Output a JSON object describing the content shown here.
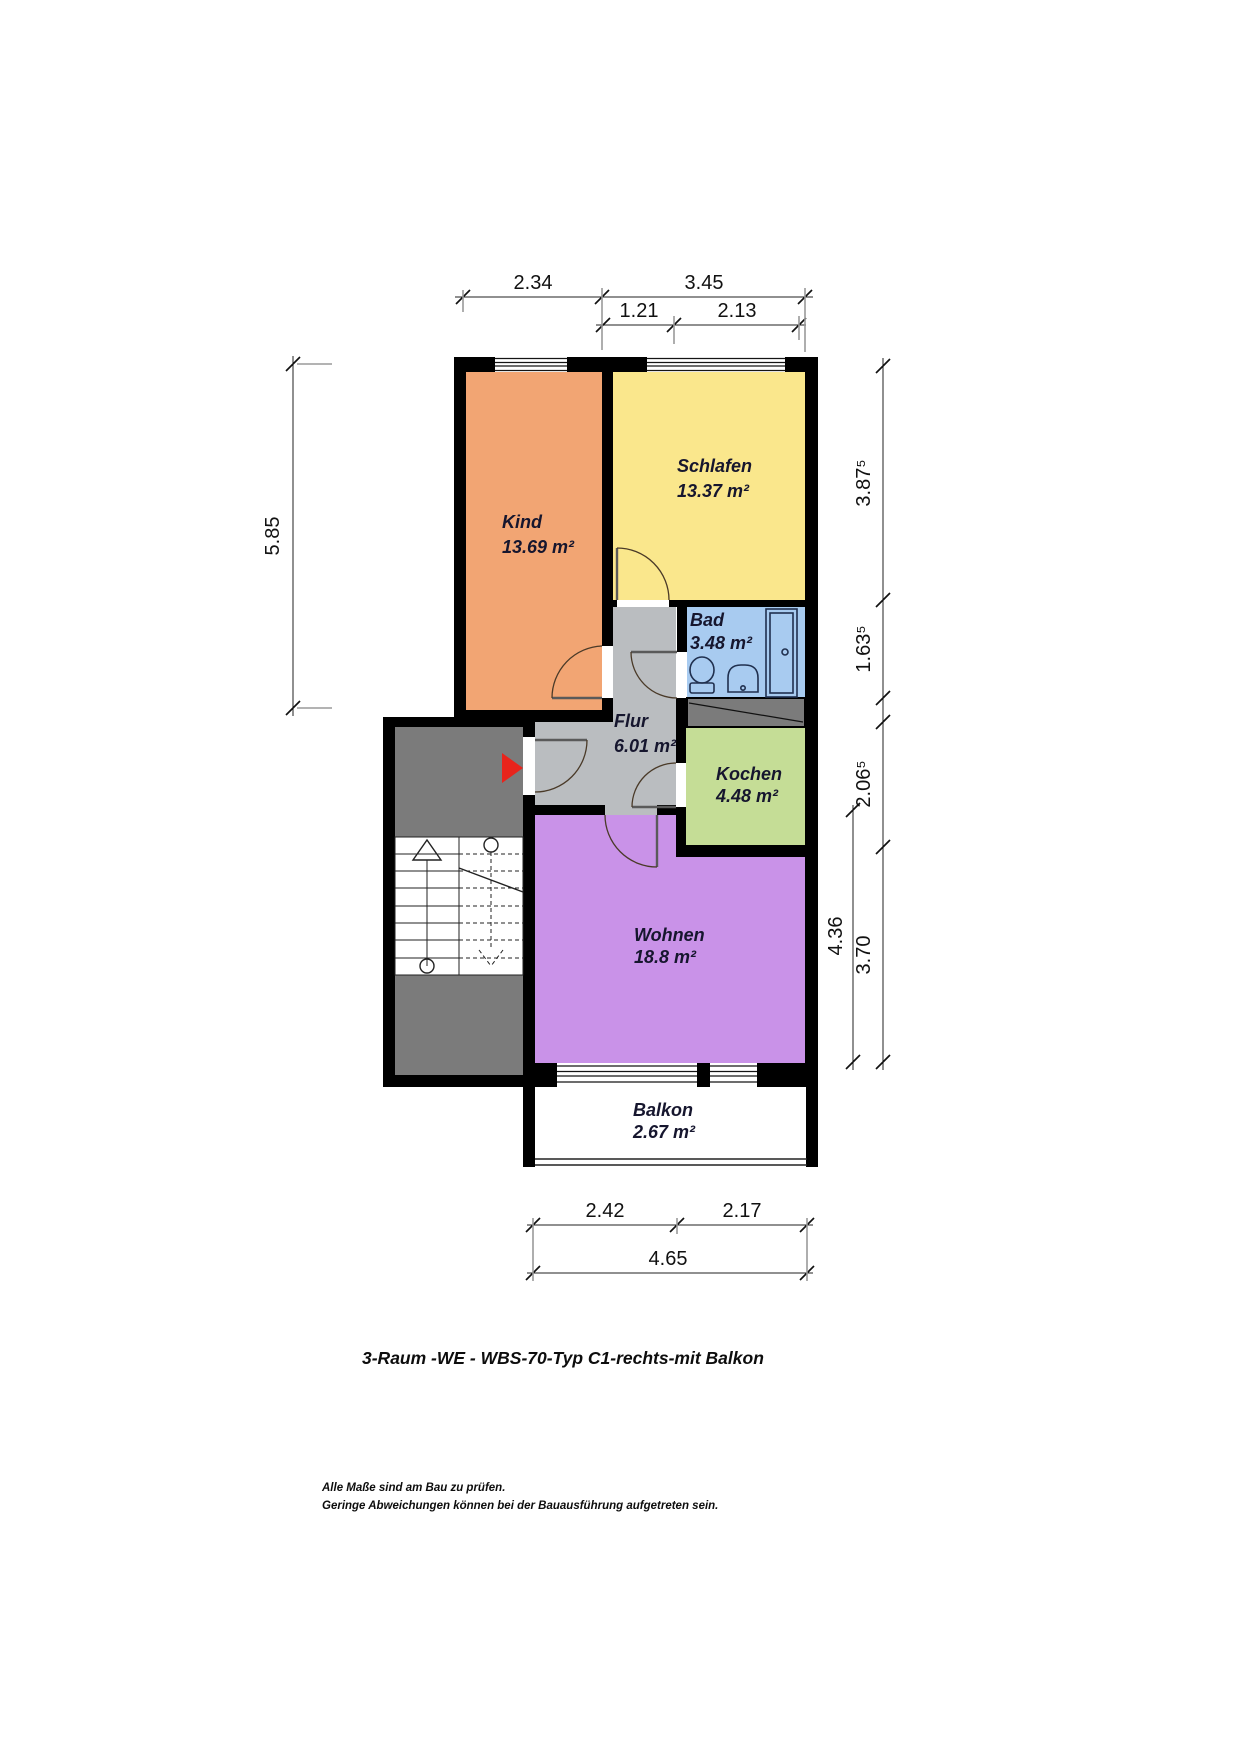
{
  "title": "3-Raum -WE - WBS-70-Typ C1-rechts-mit Balkon",
  "footer": {
    "line1": "Alle Maße sind am Bau zu prüfen.",
    "line2": "Geringe Abweichungen können bei der Bauausführung aufgetreten sein."
  },
  "rooms": [
    {
      "name": "Kind",
      "area": "13.69 m²",
      "color": "#f2a573"
    },
    {
      "name": "Schlafen",
      "area": "13.37 m²",
      "color": "#fae78c"
    },
    {
      "name": "Bad",
      "area": "3.48 m²",
      "color": "#a8cbf0"
    },
    {
      "name": "Flur",
      "area": "6.01 m²",
      "color": "#babdc0"
    },
    {
      "name": "Kochen",
      "area": "4.48 m²",
      "color": "#c5dd96"
    },
    {
      "name": "Wohnen",
      "area": "18.8 m²",
      "color": "#c992e8"
    },
    {
      "name": "Balkon",
      "area": "2.67 m²",
      "color": "#ffffff"
    }
  ],
  "dims": {
    "top": [
      "2.34",
      "3.45"
    ],
    "top_inner": [
      "1.21",
      "2.13"
    ],
    "left": "5.85",
    "right": [
      "3.87⁵",
      "1.63⁵",
      "2.06⁵",
      "3.70"
    ],
    "right_inner": "4.36",
    "bottom": [
      "2.42",
      "2.17"
    ],
    "bottom_total": "4.65"
  },
  "colors": {
    "wall": "#000000",
    "dark_area": "#7b7b7b",
    "entrance_arrow": "#e8241c"
  },
  "fixtures": {
    "bad": [
      "toilet",
      "sink",
      "shower"
    ],
    "entrance_marker": "red-arrow",
    "staircase": "two-flight-stairs"
  }
}
